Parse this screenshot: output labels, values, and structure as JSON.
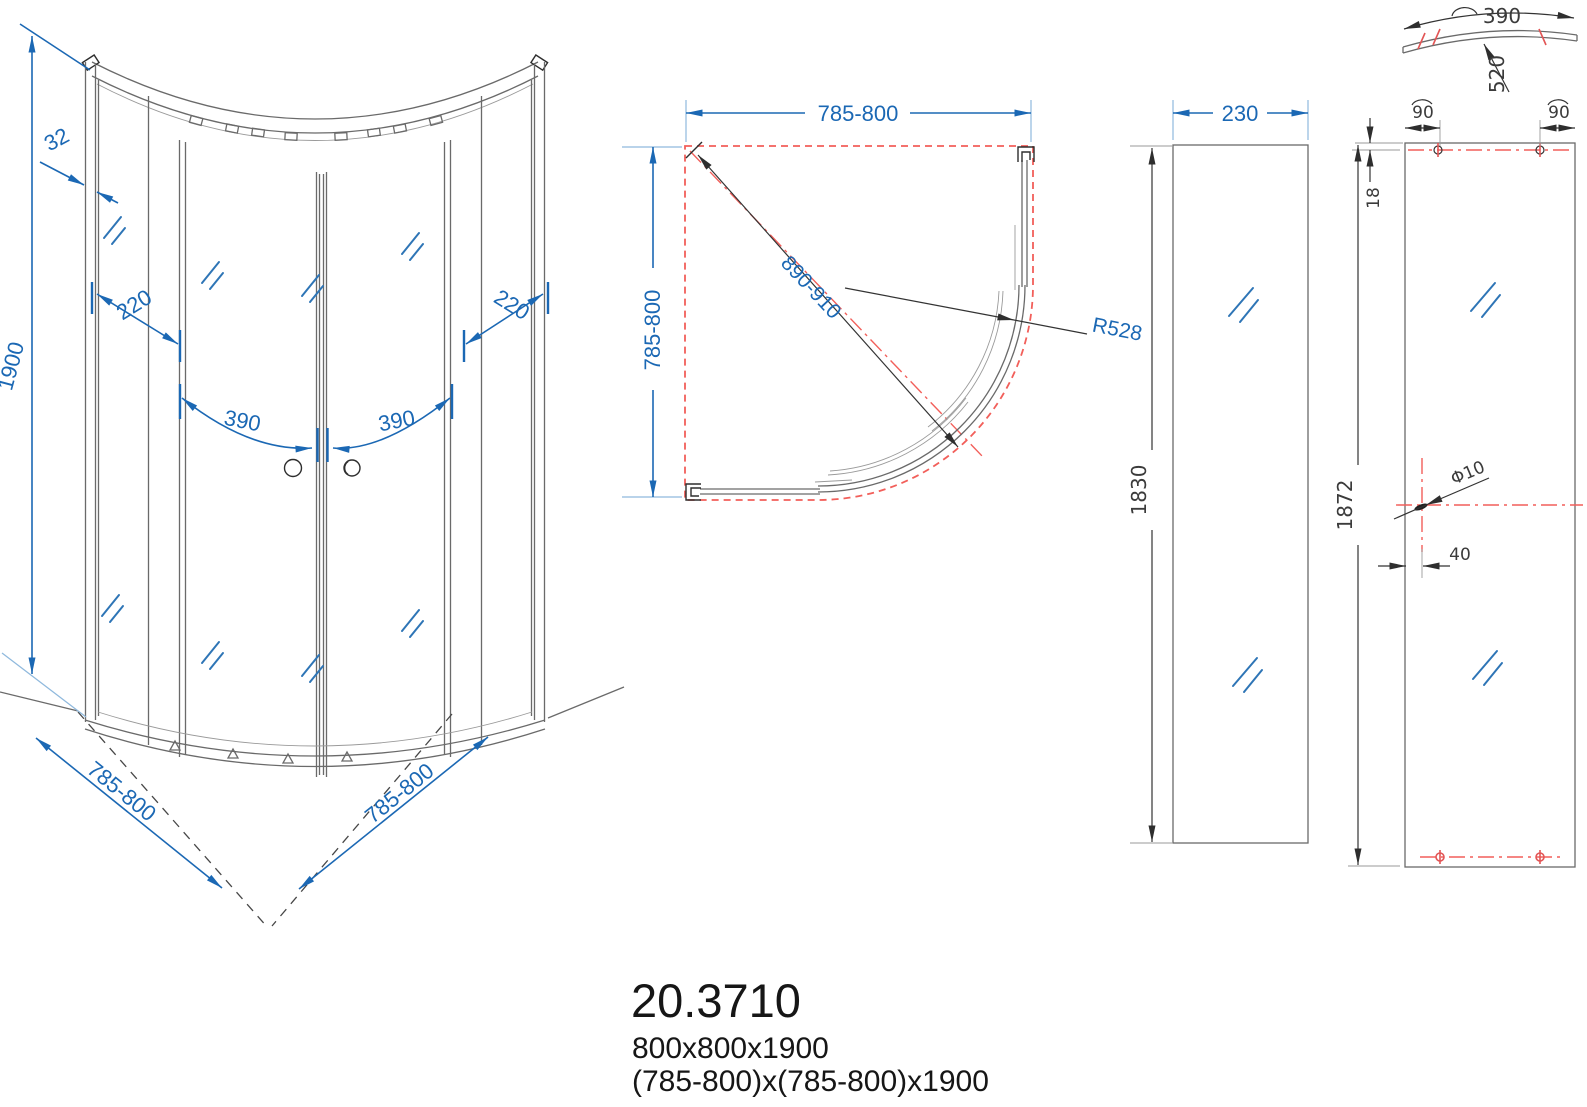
{
  "colors": {
    "dimension_blue": "#1b68b4",
    "extension_blue": "#8fb9dd",
    "centerline_red": "#f25f5a",
    "drawing_gray": "#6a6a6a",
    "dark_dim_text": "#3b3b3b",
    "title_text": "#161616"
  },
  "front_view": {
    "height": "1900",
    "profile_depth": "32",
    "fixed_panel_left": "220",
    "fixed_panel_right": "220",
    "door_left": "390",
    "door_right": "390",
    "base_left": "785-800",
    "base_right": "785-800"
  },
  "plan_view": {
    "width": "785-800",
    "depth": "785-800",
    "diagonal_opening": "890-910",
    "radius": "R528"
  },
  "side_panel_view": {
    "width": "230",
    "height": "1830"
  },
  "glass_panel_view": {
    "arc_width": "390",
    "curve_radius": "520",
    "hole_offset_left": "90",
    "hole_offset_right": "90",
    "hole_top_offset": "18",
    "height": "1872",
    "hole_diameter": "Φ10",
    "hole_side_offset": "40"
  },
  "title_block": {
    "model": "20.3710",
    "size": "800x800x1900",
    "size_range": "(785-800)x(785-800)x1900"
  }
}
